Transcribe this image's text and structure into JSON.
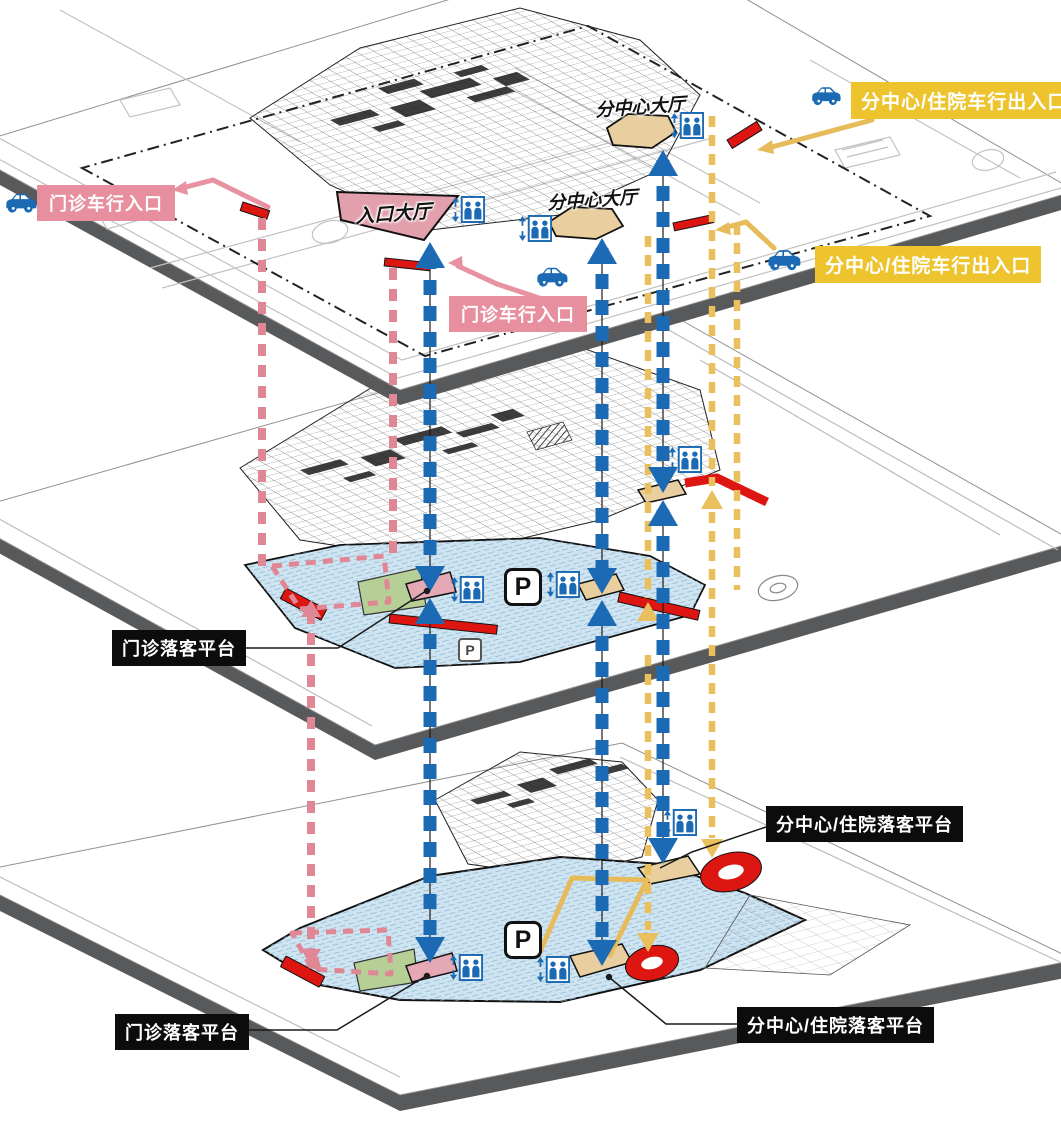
{
  "colors": {
    "arrow_blue": "#1b6ab3",
    "route_yellow": "#eac05e",
    "route_pink": "#e08795",
    "label_yellow_bg": "#edc42e",
    "label_pink_bg": "#e78f9e",
    "label_black_bg": "#0c0c0c",
    "parking_fill": "#cfe4f1",
    "hall_tan": "#e9cf9f",
    "hall_pink": "#e2a0ad",
    "green_area": "#b5cf97",
    "accent_red": "#dd1612",
    "slab_gray": "#58595b"
  },
  "icons": {
    "car": "car-icon",
    "elevator": "elevator-icon"
  },
  "labels": {
    "outpatient_vehicle_entrance": "门诊车行入口",
    "subcenter_inpatient_vehicle_exit": "分中心/住院车行出入口",
    "entrance_hall": "入口大厅",
    "subcenter_hall": "分中心大厅",
    "outpatient_dropoff_platform": "门诊落客平台",
    "subcenter_inpatient_dropoff_platform": "分中心/住院落客平台",
    "parking_symbol": "P"
  }
}
